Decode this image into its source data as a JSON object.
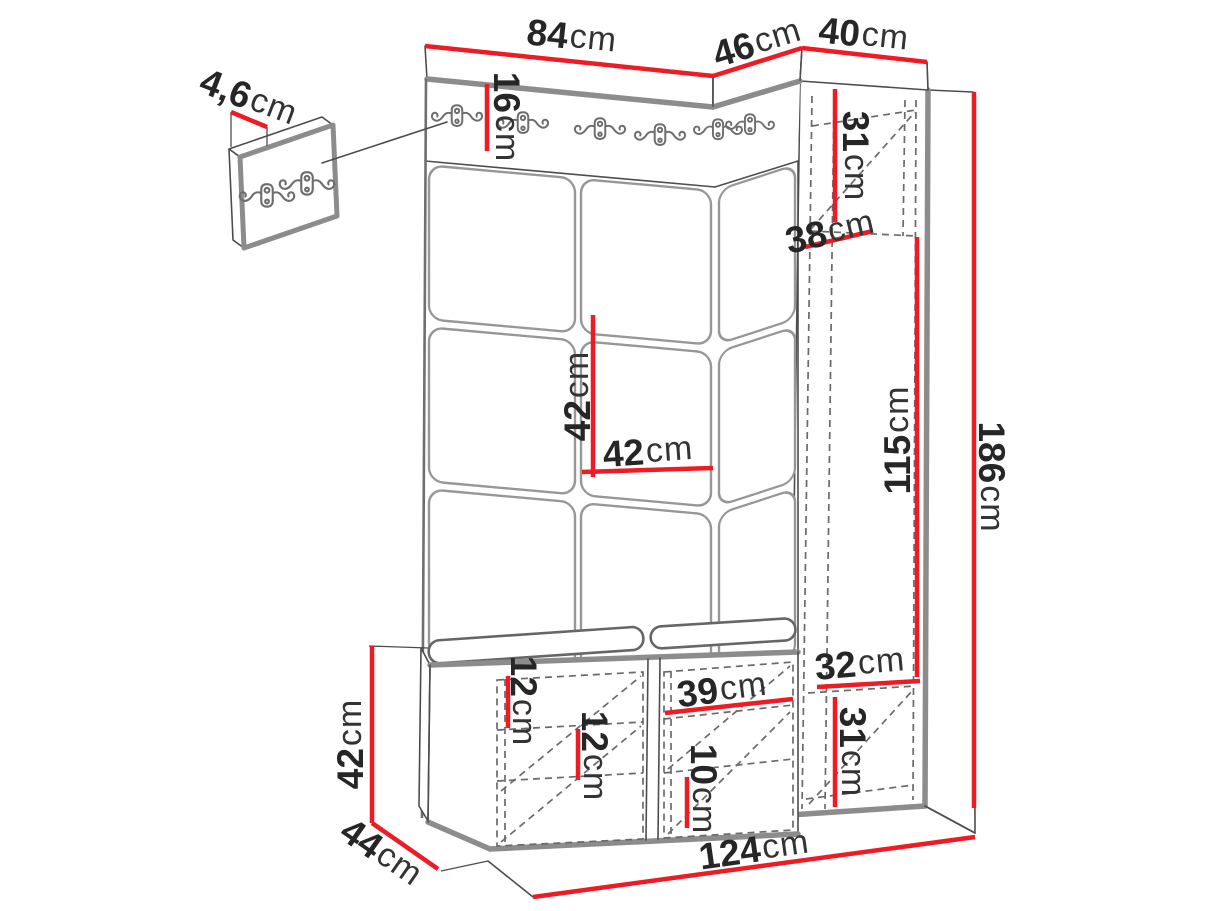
{
  "diagram_title": "Hallway wardrobe set with bench, hook rail and tall cabinet - dimension drawing",
  "accent_color": "#ee1b24",
  "line_color": "#4d4d4d",
  "dims": {
    "top_width": {
      "value": "84",
      "unit": "cm"
    },
    "corner_top_width": {
      "value": "46",
      "unit": "cm"
    },
    "side_cabinet_width": {
      "value": "40",
      "unit": "cm"
    },
    "hook_panel_thickness": {
      "value": "4,6",
      "unit": "cm"
    },
    "hook_rail_height": {
      "value": "16",
      "unit": "cm"
    },
    "cabinet_top_compartment_height": {
      "value": "31",
      "unit": "cm"
    },
    "cabinet_inner_depth": {
      "value": "38",
      "unit": "cm"
    },
    "panel_tile_height": {
      "value": "42",
      "unit": "cm"
    },
    "panel_tile_width": {
      "value": "42",
      "unit": "cm"
    },
    "hanging_space_height": {
      "value": "115",
      "unit": "cm"
    },
    "total_height": {
      "value": "186",
      "unit": "cm"
    },
    "cabinet_inner_width": {
      "value": "32",
      "unit": "cm"
    },
    "cabinet_bottom_compartment_height": {
      "value": "31",
      "unit": "cm"
    },
    "bench_top_gap_height": {
      "value": "12",
      "unit": "cm"
    },
    "bench_shelf_gap_height": {
      "value": "12",
      "unit": "cm"
    },
    "bench_compartment_width": {
      "value": "39",
      "unit": "cm"
    },
    "bench_bottom_gap_height": {
      "value": "10",
      "unit": "cm"
    },
    "bench_height": {
      "value": "42",
      "unit": "cm"
    },
    "bench_depth": {
      "value": "44",
      "unit": "cm"
    },
    "total_width": {
      "value": "124",
      "unit": "cm"
    }
  }
}
